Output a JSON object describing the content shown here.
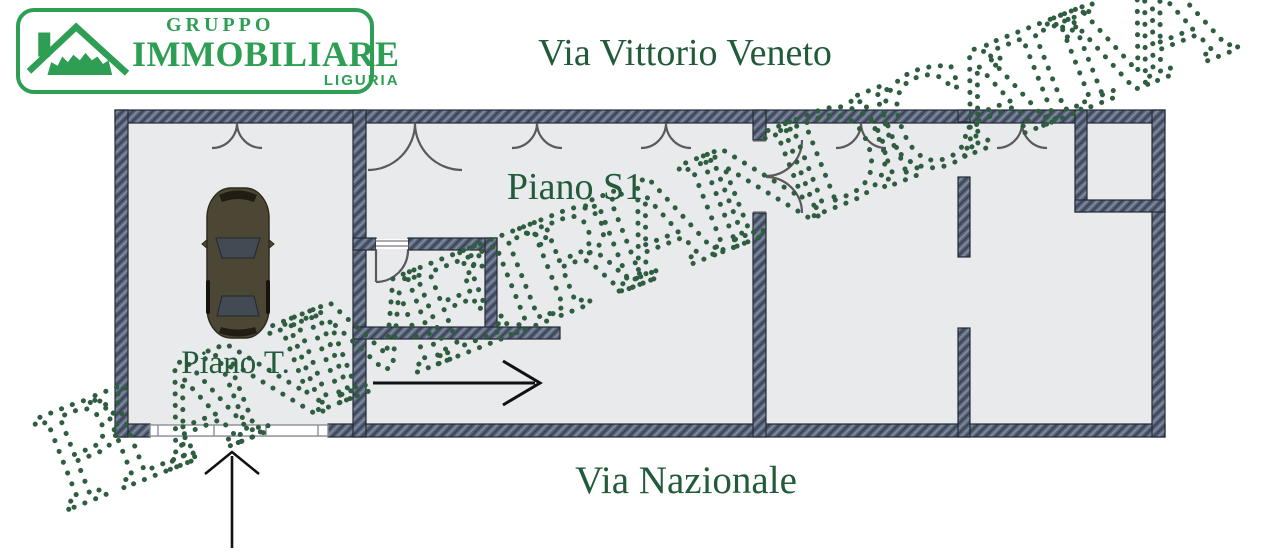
{
  "logo": {
    "line1": "GRUPPO",
    "line2": "IMMOBILIARE",
    "line3": "LIGURIA"
  },
  "streets": {
    "top": "Via Vittorio Veneto",
    "bottom": "Via Nazionale"
  },
  "plan": {
    "floor_label_s1": "Piano S1",
    "floor_label_t": "Piano T.",
    "rooms": [
      "garage Piano T with car",
      "Piano S1 open space with inner stair room",
      "middle room",
      "right room with corner closet"
    ],
    "icons": [
      "double-door-arc",
      "bifold-door-arc",
      "single-door-arc",
      "garage-sectional-door",
      "car-top-view",
      "entrance-up-arrow",
      "direction-right-arrow"
    ]
  },
  "watermark": {
    "text": "PLANIMETRIA INDICATIVA"
  },
  "colors": {
    "logo_green": "#2f9e55",
    "label_green": "#215b39",
    "watermark_green": "#2e5d40",
    "wall_fill": "#57627a",
    "wall_outline": "#232a36",
    "floor_fill": "#e9eaeb",
    "door_stroke": "#5a5a5a",
    "arrow_black": "#111111",
    "car_body": "#4c4734"
  }
}
